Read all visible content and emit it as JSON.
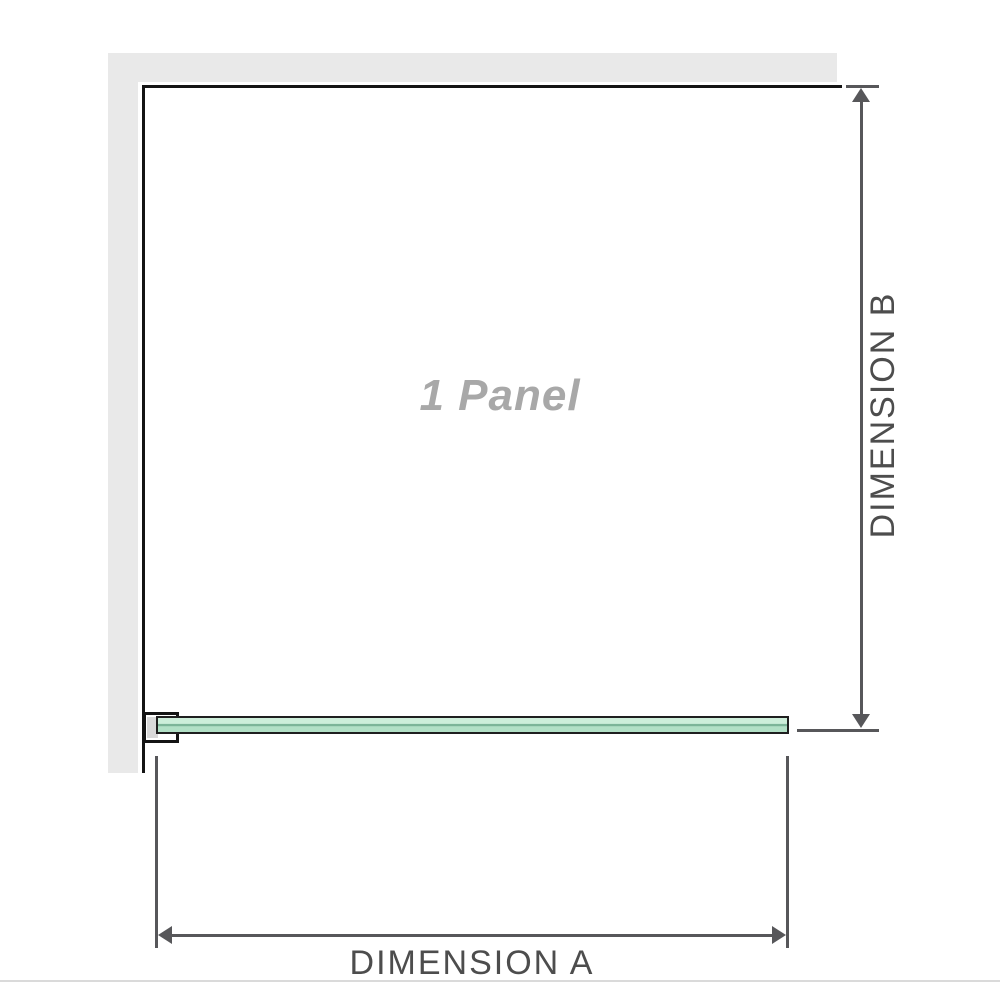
{
  "diagram": {
    "panel_label": "1 Panel",
    "dimension_a_label": "DIMENSION A",
    "dimension_b_label": "DIMENSION B"
  },
  "colors": {
    "background": "#ffffff",
    "wall": "#e9e9e9",
    "panel_outline": "#141414",
    "dimension_lines": "#57575a",
    "dimension_text": "#4d4d4d",
    "panel_label_text": "#a8a8a8",
    "glass_green_light": "#cdeeda",
    "glass_green_mid": "#7ab397",
    "glass_green_shade": "#b2e0c6",
    "glass_border": "#1f1f1f",
    "bracket_shim": "#d9d9d9"
  }
}
